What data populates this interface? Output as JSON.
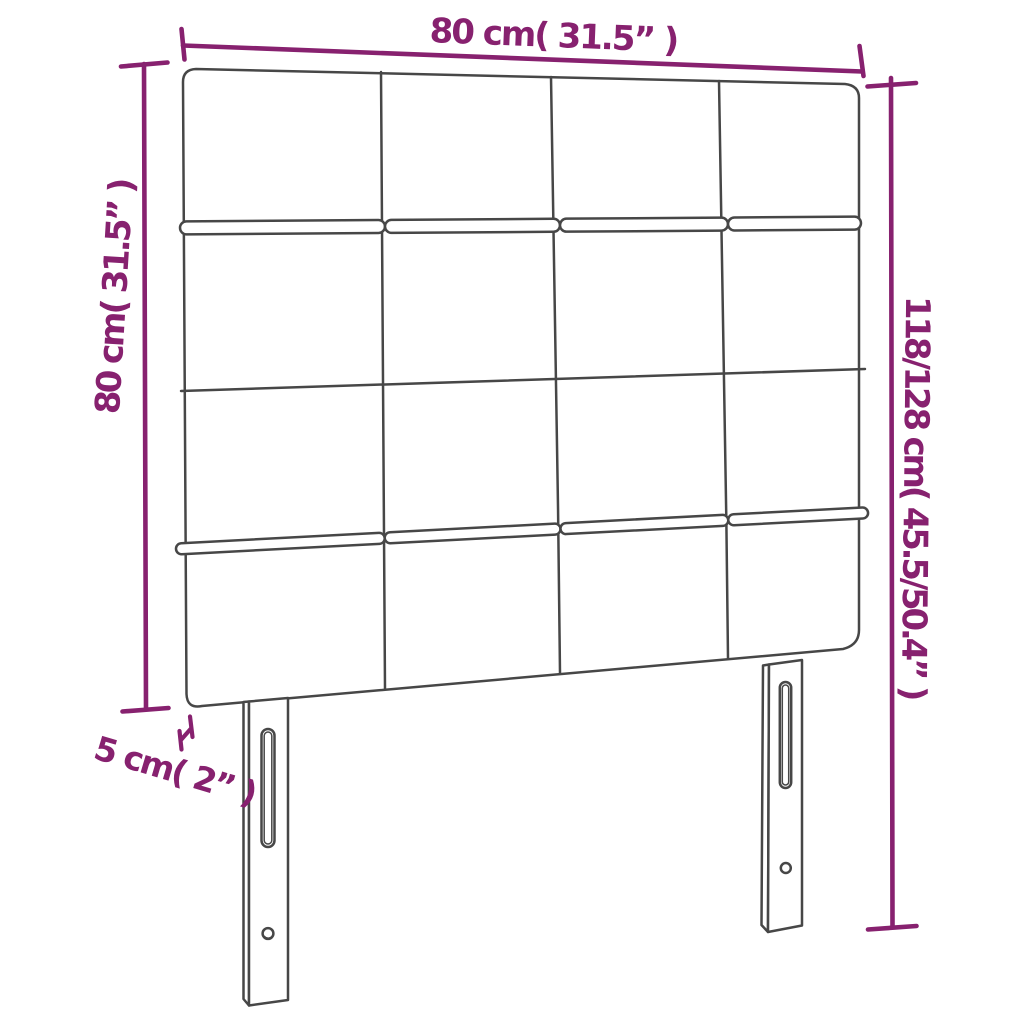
{
  "page": {
    "title": "Headboard dimension diagram",
    "type": "product-dimension-diagram"
  },
  "colors": {
    "accent": "#87216f",
    "line": "#474747",
    "background": "#ffffff"
  },
  "labels": {
    "width_top": "80 cm( 31.5” )",
    "height_left": "80 cm( 31.5” )",
    "height_right": "118/128 cm( 45.5/50.4” )",
    "thickness_bottom": "5 cm( 2” )"
  },
  "figure": {
    "subject": "upholstered headboard with two slotted legs",
    "panel_grid": {
      "rows": 4,
      "columns": 4
    },
    "legs": {
      "count": 2,
      "slot_holes_per_leg": 1,
      "round_holes_per_leg": 1
    }
  }
}
